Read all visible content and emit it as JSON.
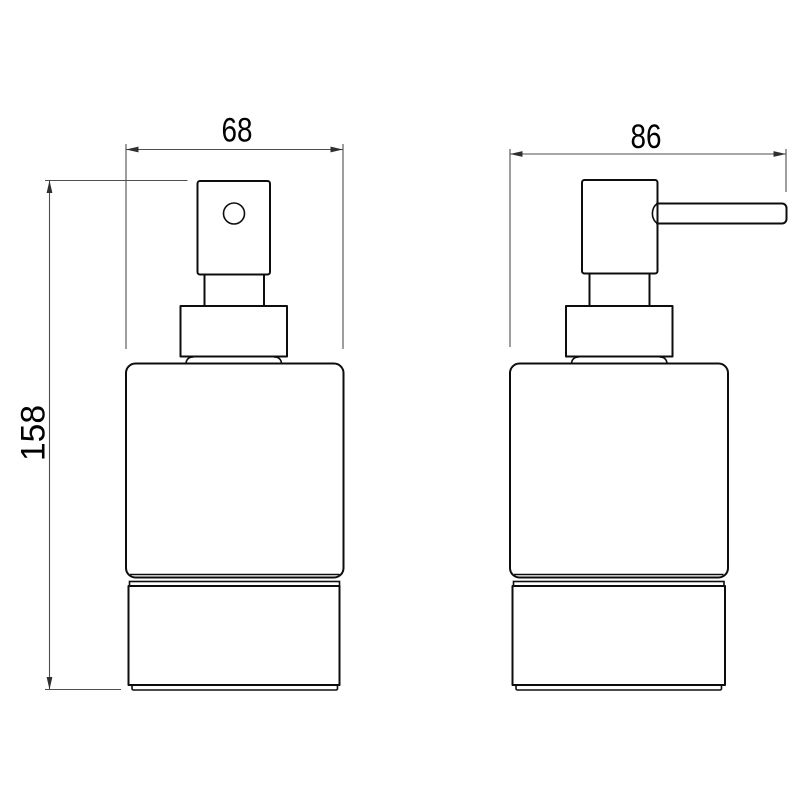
{
  "drawing": {
    "dimension_front_width": "68",
    "dimension_side_depth": "86",
    "dimension_height": "158"
  },
  "colors": {
    "background": "#ffffff",
    "object_line": "#0d0d0d",
    "dimension_line": "#4f4f4f",
    "arrow": "#2f2f2f",
    "text": "#000000"
  }
}
